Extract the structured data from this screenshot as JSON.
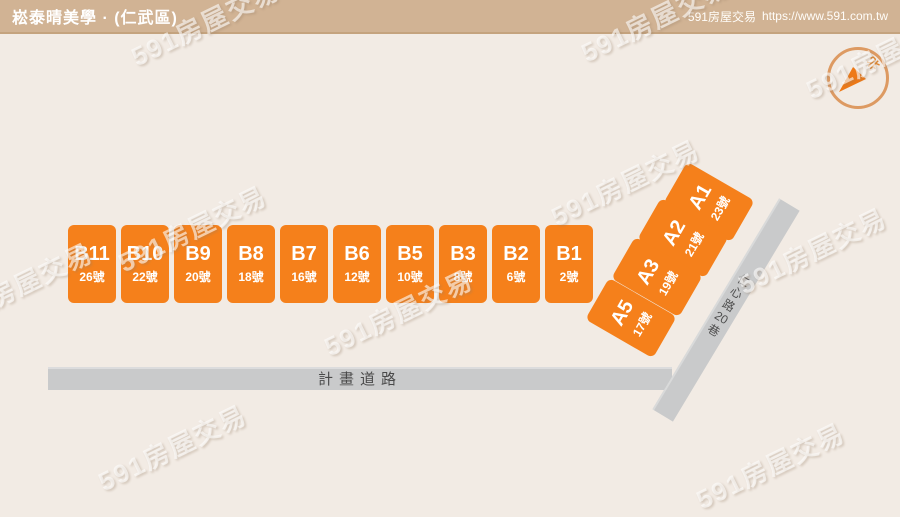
{
  "header": {
    "title": "崧泰晴美學 · (仁武區)",
    "site_label": "591房屋交易",
    "site_url": "https://www.591.com.tw"
  },
  "watermark": {
    "text": "591房屋交易"
  },
  "compass": {
    "north_label": "北"
  },
  "site_plan": {
    "b_blocks": [
      {
        "name": "B11",
        "number": "26號"
      },
      {
        "name": "B10",
        "number": "22號"
      },
      {
        "name": "B9",
        "number": "20號"
      },
      {
        "name": "B8",
        "number": "18號"
      },
      {
        "name": "B7",
        "number": "16號"
      },
      {
        "name": "B6",
        "number": "12號"
      },
      {
        "name": "B5",
        "number": "10號"
      },
      {
        "name": "B3",
        "number": "8號"
      },
      {
        "name": "B2",
        "number": "6號"
      },
      {
        "name": "B1",
        "number": "2號"
      }
    ],
    "a_blocks": [
      {
        "name": "A1",
        "number": "23號"
      },
      {
        "name": "A2",
        "number": "21號"
      },
      {
        "name": "A3",
        "number": "19號"
      },
      {
        "name": "A5",
        "number": "17號"
      }
    ],
    "roads": {
      "main_road": {
        "label": "計畫道路"
      },
      "lane": {
        "label": "仁心路20巷",
        "chars": [
          "仁",
          "心",
          "路",
          "20",
          "巷"
        ]
      }
    }
  },
  "colors": {
    "block_orange": "#f5801b",
    "header_tan": "#d1b394",
    "road_gray": "#c9cacb",
    "background": "#f2ebe4",
    "compass_orange": "#dd9a62"
  }
}
